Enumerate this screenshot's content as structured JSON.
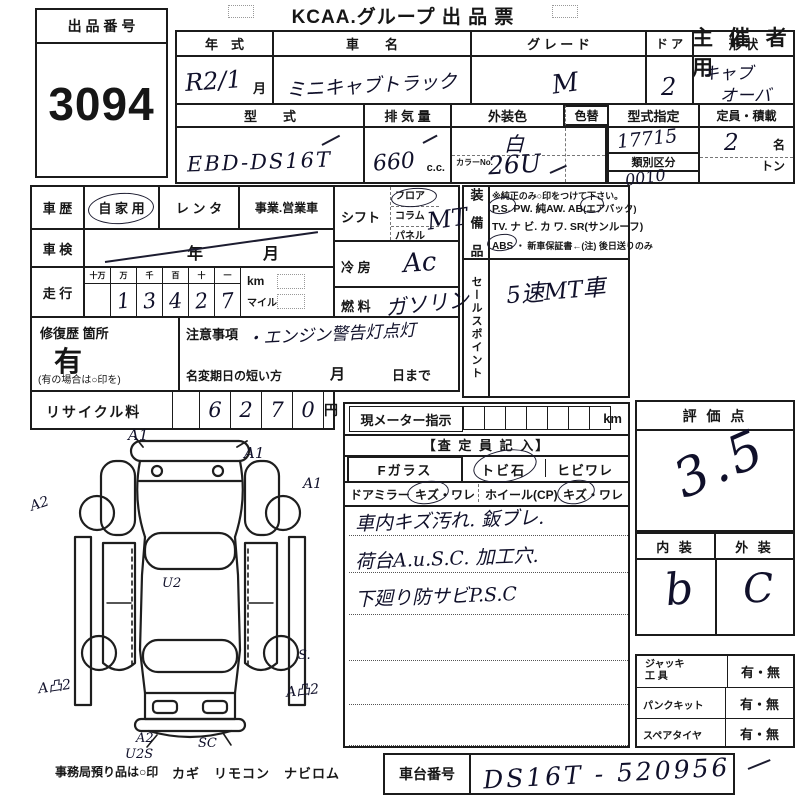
{
  "page": {
    "title": "KCAA.グループ 出 品 票",
    "organizer": "主 催 者 用"
  },
  "exhibit": {
    "label": "出 品 番 号",
    "number": "3094"
  },
  "top_table": {
    "year_label": "年　式",
    "year_value": "R2/1",
    "month": "月",
    "name_label": "車　　名",
    "name_value": "ミニキャブトラック",
    "grade_label": "グ レ ー ド",
    "grade_value": "M",
    "door_label": "ド ア",
    "door_value": "2",
    "shape_label": "形 状",
    "shape_value1": "キャブ",
    "shape_value2": "オーバ",
    "model_label": "型　　式",
    "model_value": "EBD-DS16T",
    "disp_label": "排 気 量",
    "disp_value": "660",
    "disp_unit": "c.c.",
    "color_label": "外装色",
    "color_value": "白",
    "color_no_label": "カラーNo.",
    "color_no_value": "26U",
    "color_change_label": "色替",
    "type_desig_label": "型式指定",
    "type_desig_value": "17715",
    "class_label": "類別区分",
    "class_value": "0010",
    "capacity_label": "定員・積載",
    "capacity_value": "2",
    "capacity_unit": "名",
    "ton_label": "トン"
  },
  "history": {
    "label": "車 歴",
    "opt_private": "自 家 用",
    "opt_rental": "レ ン タ",
    "opt_business": "事業.営業車",
    "inspection_label": "車 検",
    "inspection_year_unit": "年",
    "inspection_month_unit": "月",
    "mileage_label": "走 行",
    "digit_headers": [
      "十万",
      "万",
      "千",
      "百",
      "十",
      "一"
    ],
    "digits": [
      "",
      "1",
      "3",
      "4",
      "2",
      "7"
    ],
    "unit_km": "km",
    "unit_mile": "マイル"
  },
  "repair": {
    "label": "修復歴 箇所",
    "value": "有",
    "note": "(有の場合は○印を)"
  },
  "caution": {
    "label": "注意事項",
    "value": "・エンジン警告灯点灯",
    "name_change": "名変期日の短い方",
    "month": "月",
    "until": "日まで"
  },
  "recycle": {
    "label": "リサイクル料",
    "digits": [
      "6",
      "2",
      "7",
      "0"
    ],
    "unit": "円"
  },
  "drivetrain": {
    "shift_label": "シフト",
    "shift_floor": "フロア",
    "shift_column": "コラム",
    "shift_panel": "パネル",
    "shift_value": "MT",
    "ac_label": "冷 房",
    "ac_value": "Ac",
    "fuel_label": "燃 料",
    "fuel_value": "ガソリン"
  },
  "equipment": {
    "label": "装 備 品",
    "note": "※純正のみ○印をつけて下さい。",
    "ps": "P.S.",
    "pw": "PW.",
    "aw": "純AW.",
    "ab": "AB",
    "ab_note": "(エアバック)",
    "tv": "TV.",
    "navi": "ナ ビ.",
    "kawa": "カ ワ.",
    "sr": "SR(サンルーフ)",
    "abs": "ABS",
    "warranty": "・ 新車保証書←(注) 後日送りのみ"
  },
  "sales_point": {
    "label": "セールスポイント",
    "value": "5速MT車"
  },
  "meter": {
    "label": "現メーター指示",
    "unit": "km"
  },
  "assessor": {
    "header": "【査 定 員 記 入】",
    "f_glass": "Fガラス",
    "tobi": "トビ石",
    "hibi": "ヒビワレ",
    "door_mirror": "ドアミラー",
    "mirror_dmg": "キズ・ワレ",
    "wheel": "ホイール(CP)",
    "wheel_dmg": "キズ・ワレ",
    "notes": [
      "車内キズ汚れ. 鈑ブレ.",
      "荷台A.u.S.C. 加工穴.",
      "下廻り防サビP.S.C"
    ]
  },
  "score": {
    "label": "評 価 点",
    "value": "3.5"
  },
  "grade_in_ex": {
    "interior_label": "内 装",
    "exterior_label": "外 装",
    "interior_value": "b",
    "exterior_value": "C"
  },
  "tools": {
    "jack_label1": "ジャッキ",
    "jack_label2": "工 具",
    "jack_value": "有・無",
    "punk_label": "パンクキット",
    "punk_value": "有・無",
    "spare_label": "スペアタイヤ",
    "spare_value": "有・無"
  },
  "chassis": {
    "label": "車台番号",
    "value": "DS16T - 520956"
  },
  "footer": {
    "note": "事務局預り品は○印",
    "items": "カギ　リモコン　ナビロム"
  },
  "diagram": {
    "a1_front_left": "A1",
    "a1_front_right": "A1",
    "a2_left": "A2",
    "a1_right": "A1",
    "u2_center": "U2",
    "a2_rear_left": "A凸2",
    "s_rear_right": "S.",
    "a2_rear_right": "A凸2",
    "a2_bottom": "A2",
    "u2s_bottom": "U2S",
    "sc_bottom": "SC"
  }
}
